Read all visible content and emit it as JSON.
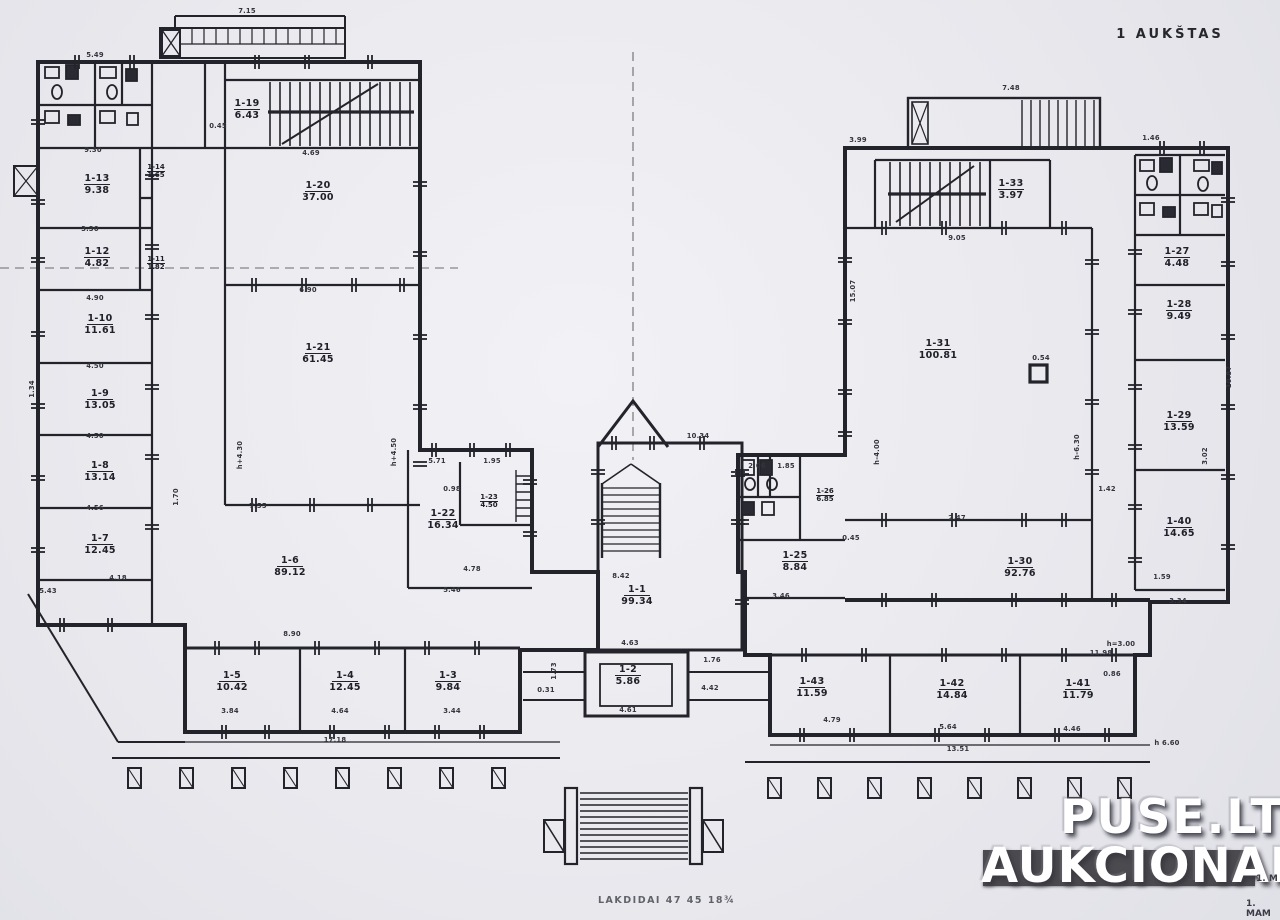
{
  "meta": {
    "floor_label": "1 AUKŠTAS"
  },
  "watermark": {
    "line1": "PUSE.LT",
    "line2": "AUKCIONAI",
    "band_color": "#4a4a4f"
  },
  "footer": {
    "note": "LAKDIDAI 47 45 18¾",
    "frag1": "1. M",
    "frag2": "1. MAM"
  },
  "colors": {
    "paper": "#e9e9ee",
    "ink": "#23232b"
  },
  "plan": {
    "rooms": [
      {
        "id": "1-19",
        "area": "6.43",
        "x": 247,
        "y": 108
      },
      {
        "id": "1-20",
        "area": "37.00",
        "x": 318,
        "y": 190
      },
      {
        "id": "1-21",
        "area": "61.45",
        "x": 318,
        "y": 352
      },
      {
        "id": "1-13",
        "area": "9.38",
        "x": 97,
        "y": 183
      },
      {
        "id": "1-14",
        "area": "1.65",
        "x": 156,
        "y": 170,
        "small": true
      },
      {
        "id": "1-12",
        "area": "4.82",
        "x": 97,
        "y": 256
      },
      {
        "id": "1-11",
        "area": "1.82",
        "x": 156,
        "y": 262,
        "small": true
      },
      {
        "id": "1-10",
        "area": "11.61",
        "x": 100,
        "y": 323
      },
      {
        "id": "1-9",
        "area": "13.05",
        "x": 100,
        "y": 398
      },
      {
        "id": "1-8",
        "area": "13.14",
        "x": 100,
        "y": 470
      },
      {
        "id": "1-7",
        "area": "12.45",
        "x": 100,
        "y": 543
      },
      {
        "id": "1-6",
        "area": "89.12",
        "x": 290,
        "y": 565
      },
      {
        "id": "1-22",
        "area": "16.34",
        "x": 443,
        "y": 518
      },
      {
        "id": "1-23",
        "area": "4.50",
        "x": 489,
        "y": 500,
        "small": true
      },
      {
        "id": "1-5",
        "area": "10.42",
        "x": 232,
        "y": 680
      },
      {
        "id": "1-4",
        "area": "12.45",
        "x": 345,
        "y": 680
      },
      {
        "id": "1-3",
        "area": "9.84",
        "x": 448,
        "y": 680
      },
      {
        "id": "1-1",
        "area": "99.34",
        "x": 637,
        "y": 594
      },
      {
        "id": "1-2",
        "area": "5.86",
        "x": 628,
        "y": 674
      },
      {
        "id": "1-25",
        "area": "8.84",
        "x": 795,
        "y": 560
      },
      {
        "id": "1-26",
        "area": "6.85",
        "x": 825,
        "y": 494,
        "small": true
      },
      {
        "id": "1-33",
        "area": "3.97",
        "x": 1011,
        "y": 188
      },
      {
        "id": "1-31",
        "area": "100.81",
        "x": 938,
        "y": 348
      },
      {
        "id": "1-30",
        "area": "92.76",
        "x": 1020,
        "y": 566
      },
      {
        "id": "1-27",
        "area": "4.48",
        "x": 1177,
        "y": 256
      },
      {
        "id": "1-28",
        "area": "9.49",
        "x": 1179,
        "y": 309
      },
      {
        "id": "1-29",
        "area": "13.59",
        "x": 1179,
        "y": 420
      },
      {
        "id": "1-40",
        "area": "14.65",
        "x": 1179,
        "y": 526
      },
      {
        "id": "1-43",
        "area": "11.59",
        "x": 812,
        "y": 686
      },
      {
        "id": "1-42",
        "area": "14.84",
        "x": 952,
        "y": 688
      },
      {
        "id": "1-41",
        "area": "11.79",
        "x": 1078,
        "y": 688
      }
    ],
    "dims": [
      {
        "t": "5.49",
        "x": 95,
        "y": 57
      },
      {
        "t": "7.15",
        "x": 247,
        "y": 13
      },
      {
        "t": "0.45",
        "x": 218,
        "y": 128
      },
      {
        "t": "4.69",
        "x": 311,
        "y": 155
      },
      {
        "t": "9.30",
        "x": 93,
        "y": 152
      },
      {
        "t": "3.30",
        "x": 90,
        "y": 231
      },
      {
        "t": "4.90",
        "x": 95,
        "y": 300
      },
      {
        "t": "4.50",
        "x": 95,
        "y": 368
      },
      {
        "t": "4.50",
        "x": 95,
        "y": 438
      },
      {
        "t": "4.56",
        "x": 95,
        "y": 510
      },
      {
        "t": "4.18",
        "x": 118,
        "y": 580
      },
      {
        "t": "5.43",
        "x": 48,
        "y": 593
      },
      {
        "t": "6.90",
        "x": 308,
        "y": 292
      },
      {
        "t": "7.55",
        "x": 258,
        "y": 508
      },
      {
        "t": "5.71",
        "x": 437,
        "y": 463
      },
      {
        "t": "1.95",
        "x": 492,
        "y": 463
      },
      {
        "t": "0.98",
        "x": 452,
        "y": 491
      },
      {
        "t": "4.78",
        "x": 472,
        "y": 571
      },
      {
        "t": "5.46",
        "x": 452,
        "y": 592
      },
      {
        "t": "8.42",
        "x": 621,
        "y": 578
      },
      {
        "t": "4.63",
        "x": 630,
        "y": 645
      },
      {
        "t": "4.61",
        "x": 628,
        "y": 712
      },
      {
        "t": "10.34",
        "x": 698,
        "y": 438
      },
      {
        "t": "1.76",
        "x": 712,
        "y": 662
      },
      {
        "t": "4.42",
        "x": 710,
        "y": 690
      },
      {
        "t": "0.31",
        "x": 546,
        "y": 692
      },
      {
        "t": "1.73",
        "x": 556,
        "y": 671,
        "r": -90
      },
      {
        "t": "3.46",
        "x": 781,
        "y": 598
      },
      {
        "t": "0.45",
        "x": 851,
        "y": 540
      },
      {
        "t": "2.06",
        "x": 757,
        "y": 468
      },
      {
        "t": "1.85",
        "x": 786,
        "y": 468
      },
      {
        "t": "9.05",
        "x": 957,
        "y": 240
      },
      {
        "t": "2.47",
        "x": 957,
        "y": 520
      },
      {
        "t": "1.42",
        "x": 1107,
        "y": 491
      },
      {
        "t": "0.54",
        "x": 1041,
        "y": 360
      },
      {
        "t": "7.48",
        "x": 1011,
        "y": 90
      },
      {
        "t": "3.99",
        "x": 858,
        "y": 142
      },
      {
        "t": "1.46",
        "x": 1151,
        "y": 140
      },
      {
        "t": "8.90",
        "x": 292,
        "y": 636
      },
      {
        "t": "17.18",
        "x": 335,
        "y": 742
      },
      {
        "t": "3.84",
        "x": 230,
        "y": 713
      },
      {
        "t": "4.64",
        "x": 340,
        "y": 713
      },
      {
        "t": "3.44",
        "x": 452,
        "y": 713
      },
      {
        "t": "4.79",
        "x": 832,
        "y": 722
      },
      {
        "t": "5.64",
        "x": 948,
        "y": 729
      },
      {
        "t": "4.46",
        "x": 1072,
        "y": 731
      },
      {
        "t": "13.51",
        "x": 958,
        "y": 751
      },
      {
        "t": "11.98",
        "x": 1101,
        "y": 655
      },
      {
        "t": "0.86",
        "x": 1112,
        "y": 676
      },
      {
        "t": "1.59",
        "x": 1162,
        "y": 579
      },
      {
        "t": "3.34",
        "x": 1178,
        "y": 603
      },
      {
        "t": "3.02",
        "x": 1207,
        "y": 456,
        "r": -90
      },
      {
        "t": "10.87",
        "x": 1231,
        "y": 377,
        "r": -90
      },
      {
        "t": "15.07",
        "x": 855,
        "y": 291,
        "r": -90
      },
      {
        "t": "1.34",
        "x": 34,
        "y": 389,
        "r": -90
      },
      {
        "t": "1.70",
        "x": 178,
        "y": 497,
        "r": -90
      },
      {
        "t": "h+4.30",
        "x": 242,
        "y": 455,
        "r": -90
      },
      {
        "t": "h+4.50",
        "x": 396,
        "y": 452,
        "r": -90
      },
      {
        "t": "h-4.00",
        "x": 879,
        "y": 452,
        "r": -90
      },
      {
        "t": "h-6.30",
        "x": 1079,
        "y": 447,
        "r": -90
      },
      {
        "t": "h=3.00",
        "x": 1121,
        "y": 646
      },
      {
        "t": "h 6.60",
        "x": 1167,
        "y": 745
      }
    ]
  }
}
